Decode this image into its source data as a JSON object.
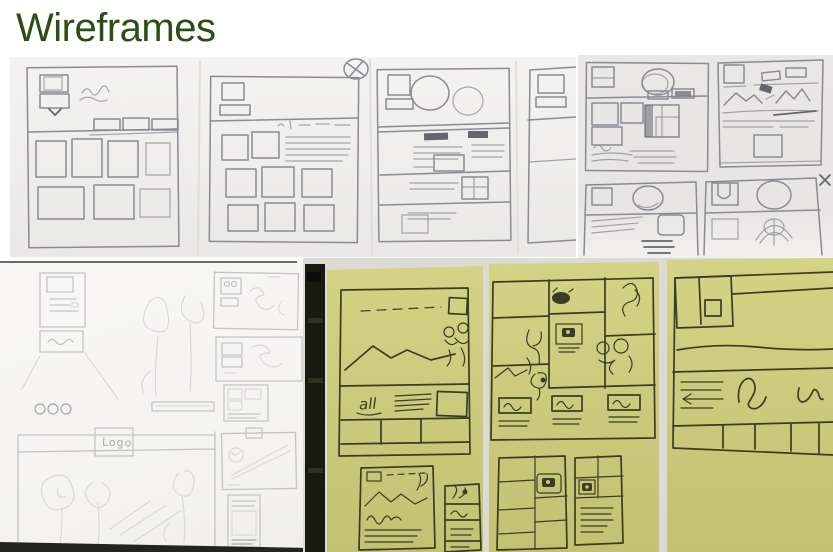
{
  "title": "Wireframes",
  "labels": {
    "logo": "Logo",
    "all": "all"
  },
  "colors": {
    "title_green": "#2d4e13",
    "sticky_note": "#cac87b",
    "sticky_note_light": "#d4d285",
    "pen_ink": "#3a3c26",
    "pencil": "#8b8994",
    "pencil_dark": "#66646d",
    "pencil_faint": "#c4c2c8",
    "photo_paper": "#f0efed",
    "dark_strip": "#181a10"
  }
}
